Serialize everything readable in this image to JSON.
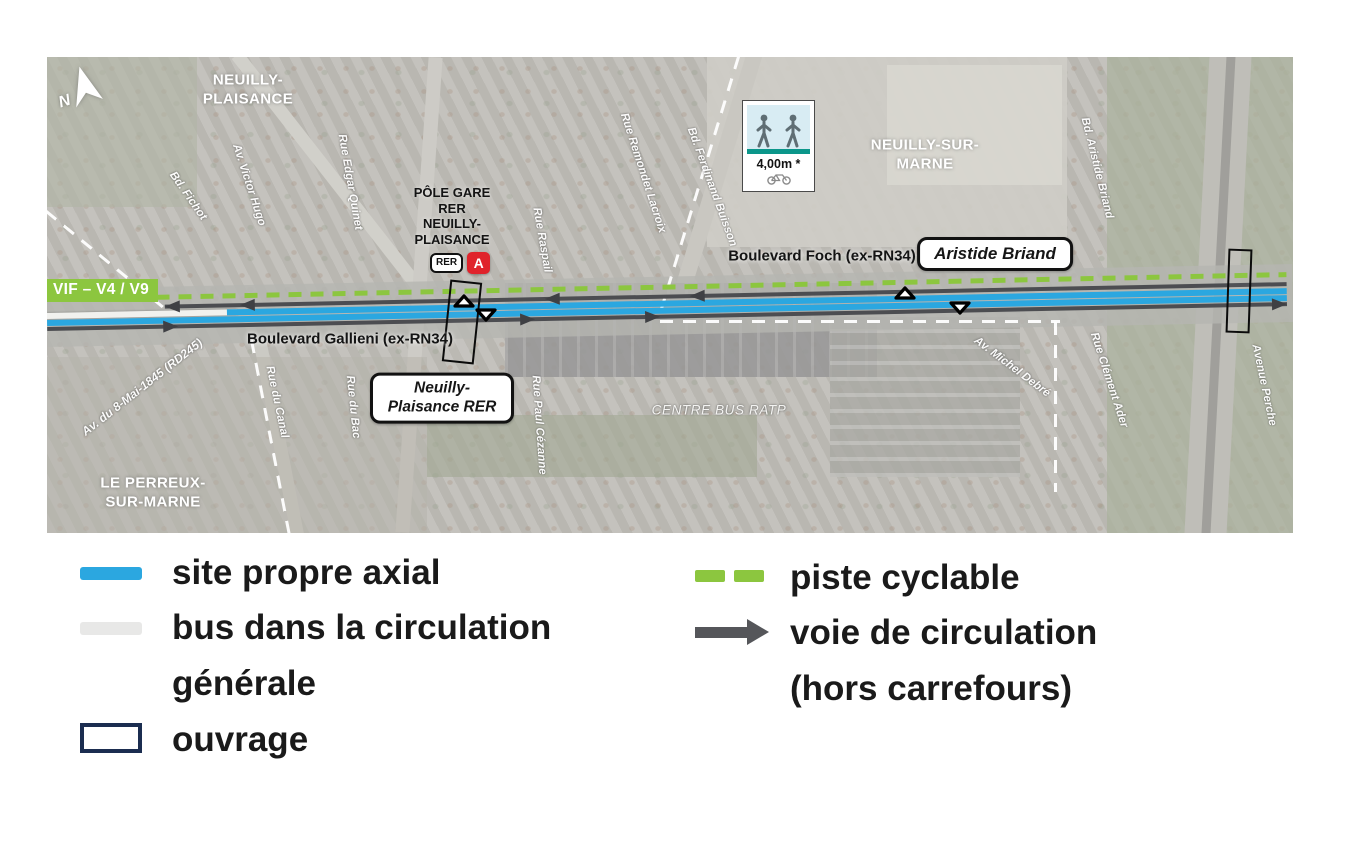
{
  "map": {
    "north_label": "N",
    "vif_badge": "VIF – V4 / V9",
    "city_labels": [
      "NEUILLY-PLAISANCE",
      "NEUILLY-SUR-MARNE",
      "LE PERREUX-SUR-MARNE"
    ],
    "station_title": "PÔLE GARE RER NEUILLY-PLAISANCE",
    "rer_badge": "RER",
    "rer_line": "A",
    "station_box": "Neuilly-Plaisance RER",
    "street_box": "Aristide Briand",
    "foch": "Boulevard Foch (ex-RN34)",
    "gallieni": "Boulevard Gallieni (ex-RN34)",
    "centre_bus": "CENTRE BUS RATP",
    "cycle_width": "4,00m *",
    "streets": [
      "Bd. Fichot",
      "Av. Victor Hugo",
      "Rue Edgar Quinet",
      "Rue Raspail",
      "Rue Remondet Lacroix",
      "Bd. Ferdinand Buisson",
      "Bd. Aristide Briand",
      "Avenue Perche",
      "Rue du Canal",
      "Rue du Bac",
      "Rue Paul Cézanne",
      "Av. Michel Debré",
      "Rue Clément Ader",
      "Av. du 8-Mai-1845 (RD245)"
    ]
  },
  "legend": {
    "left": [
      {
        "label": "site propre axial",
        "swatch": "blue-line"
      },
      {
        "label": "bus dans la circulation générale",
        "swatch": "gray-line"
      },
      {
        "label": "ouvrage",
        "swatch": "rect-outline"
      }
    ],
    "right": [
      {
        "label": "piste cyclable",
        "swatch": "green-dashes"
      },
      {
        "label": "voie de circulation (hors carrefours)",
        "swatch": "gray-arrow"
      }
    ]
  },
  "colors": {
    "site_propre": "#2ba7e0",
    "bus_general": "#e8e8e7",
    "piste_cyclable": "#8cc63f",
    "voie_circulation": "#55565a",
    "ouvrage": "#1b2d50",
    "vif_bg": "#8cc63f",
    "rer_red": "#e0232b",
    "teal_band": "#0b968a"
  }
}
